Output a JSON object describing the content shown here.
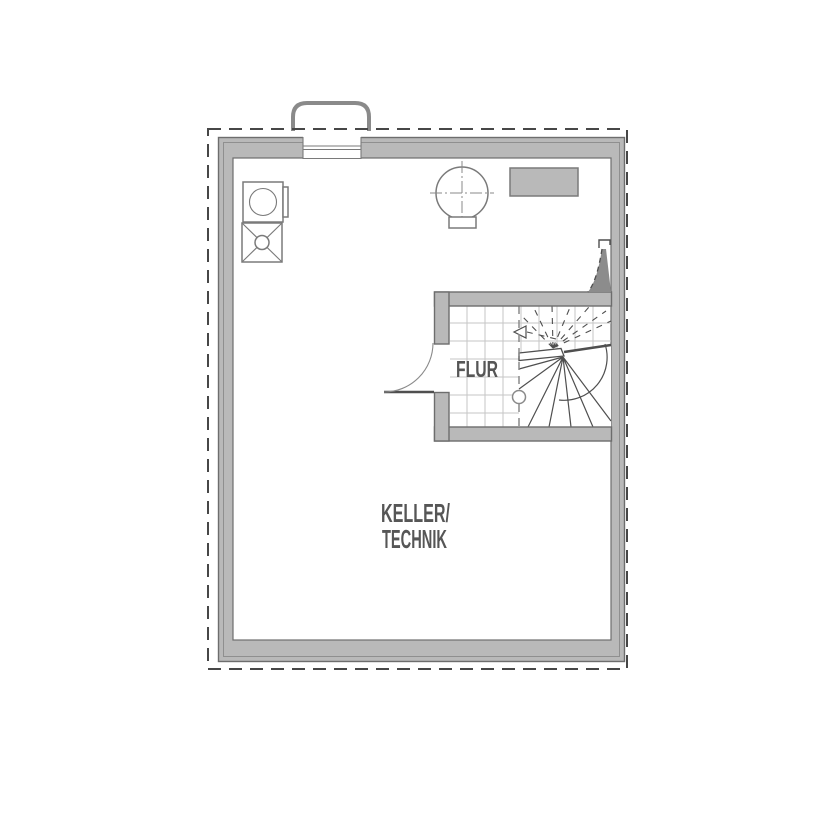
{
  "meta": {
    "type": "architectural-floor-plan",
    "floor": "basement"
  },
  "labels": {
    "flur": "FLUR",
    "keller_line1": "KELLER/",
    "keller_line2": "TECHNIK"
  },
  "colors": {
    "wall_fill": "#b9b9b9",
    "wall_edge": "#6d6d6d",
    "wall_inset": "#8f8f8f",
    "line": "#4f4f4f",
    "dash": "#474747",
    "grid": "#c6c6c6",
    "symbol_line": "#7a7a7a",
    "flue_line": "#8a8a8a",
    "furniture_fill": "#b9b9b9",
    "sail_fill": "#8c8c8c",
    "walkline": "#8a8a8a",
    "text": "#565656"
  },
  "elements": [
    {
      "name": "site-boundary",
      "symbol": "dashed-rectangle"
    },
    {
      "name": "exterior-walls",
      "symbol": "gray-double-wall"
    },
    {
      "name": "chimney-flue",
      "symbol": "rounded-duct-on-top-wall"
    },
    {
      "name": "washing-machine",
      "symbol": "square-with-circle"
    },
    {
      "name": "floor-drain",
      "symbol": "square-with-x-and-circle"
    },
    {
      "name": "boiler-tank",
      "symbol": "circle-with-centerlines"
    },
    {
      "name": "equipment-block",
      "symbol": "gray-rectangle"
    },
    {
      "name": "room-flur",
      "symbol": "tiled-room"
    },
    {
      "name": "winder-staircase",
      "symbol": "fan-steps-with-cut-line-and-walkline"
    },
    {
      "name": "flur-door",
      "symbol": "door-leaf-with-swing-arc"
    },
    {
      "name": "upper-level-door",
      "symbol": "dashed-door-sail"
    }
  ]
}
